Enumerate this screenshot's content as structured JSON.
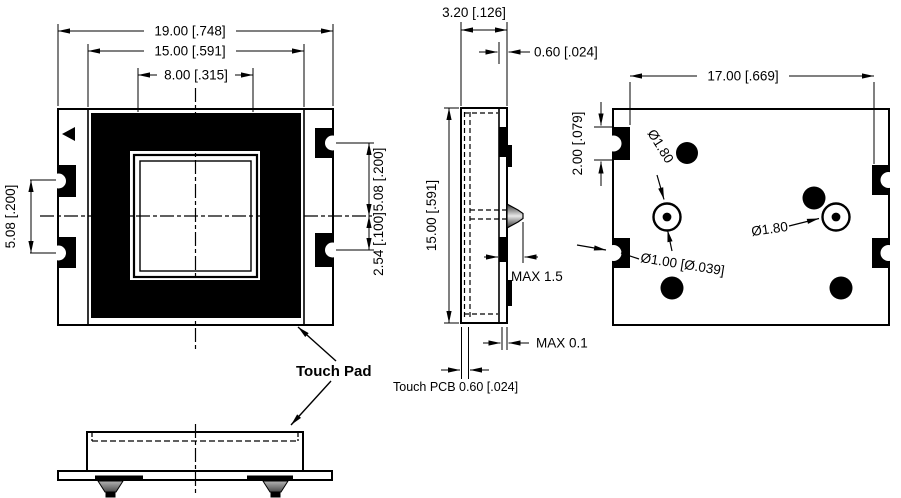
{
  "front": {
    "dim_outer": "19.00 [.748]",
    "dim_body": "15.00 [.591]",
    "dim_window": "8.00 [.315]",
    "dim_left_pitch": "5.08 [.200]",
    "dim_right_pitch_upper": "5.08 [.200]",
    "dim_right_pitch_lower": "2.54 [.100]",
    "touch_pad_label": "Touch Pad"
  },
  "side": {
    "dim_depth": "3.20 [.126]",
    "dim_pcb_thickness_top": "0.60 [.024]",
    "dim_height": "15.00 [.591]",
    "dim_bump_max": "MAX 1.5",
    "dim_protrusion_max": "MAX 0.1",
    "pcb_label": "Touch PCB 0.60 [.024]"
  },
  "back": {
    "dim_width": "17.00 [.669]",
    "dim_pad_height": "2.00 [.079]",
    "dim_hole_left": "Ø1.80",
    "dim_hole_right": "Ø1.80",
    "dim_hole_small": "Ø1.00 [Ø.039]"
  },
  "colors": {
    "line": "#000000",
    "background": "#ffffff",
    "pad_fill": "#000000"
  }
}
